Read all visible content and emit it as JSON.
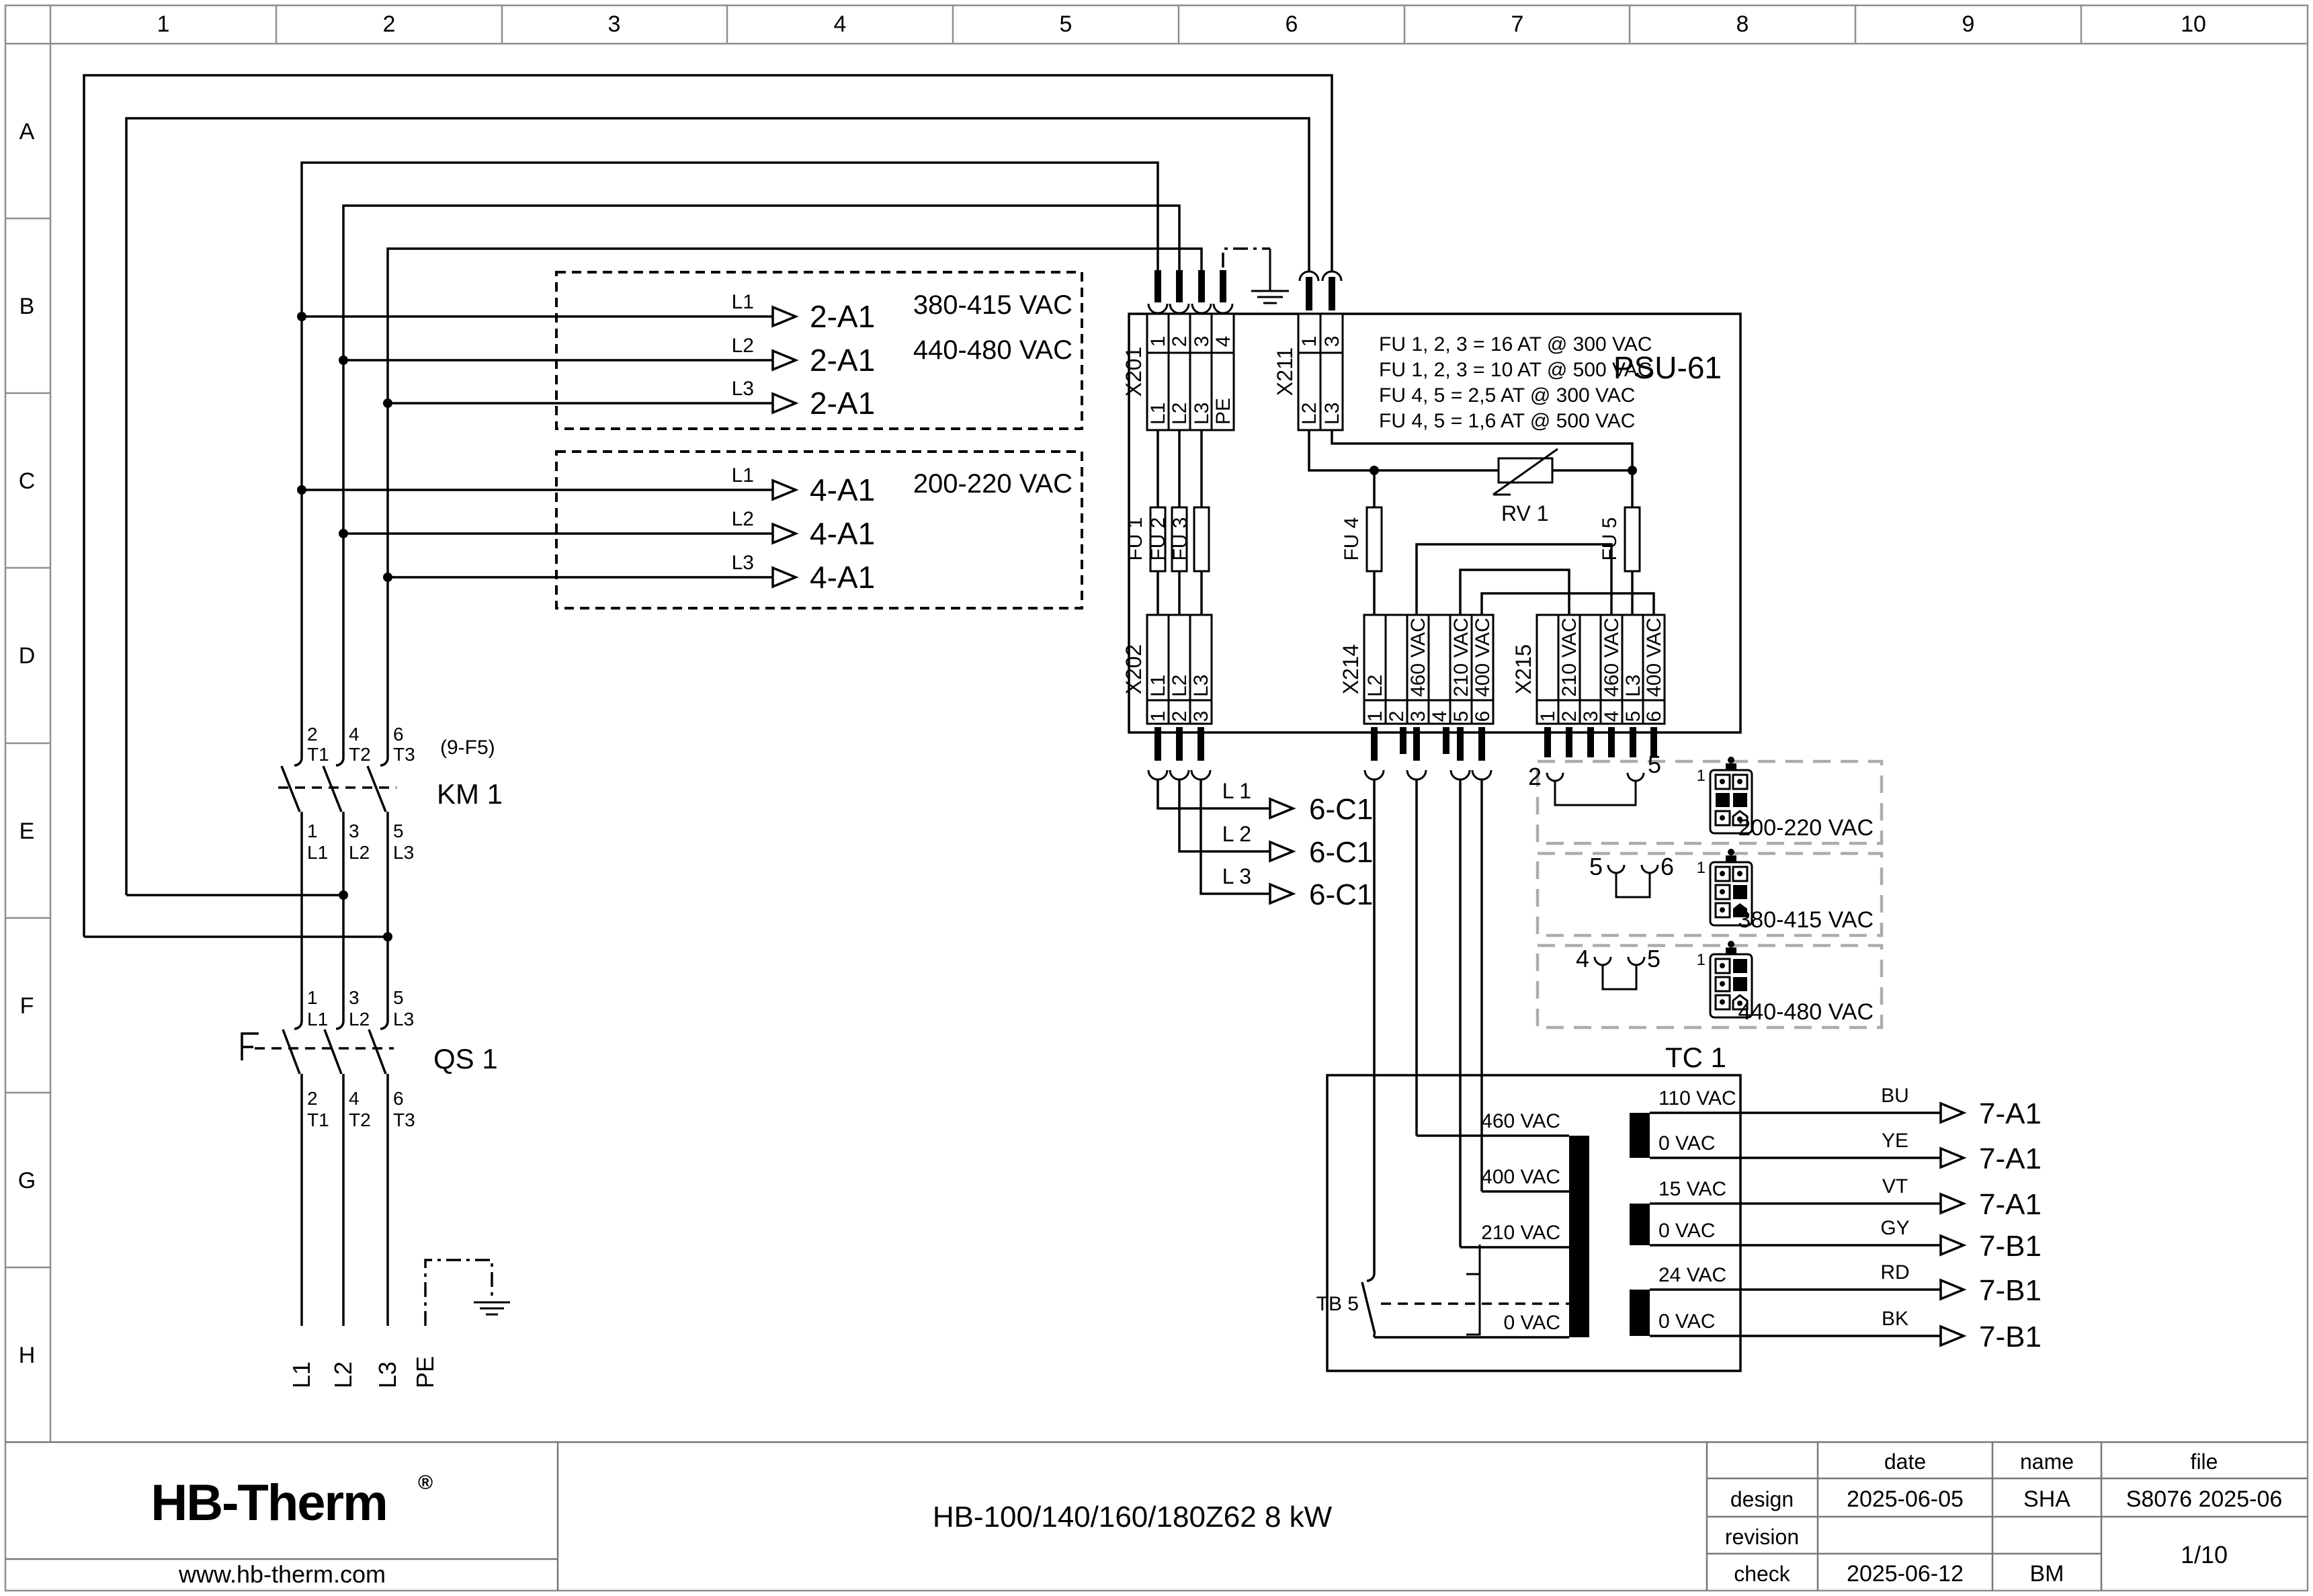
{
  "frame": {
    "columns": [
      "1",
      "2",
      "3",
      "4",
      "5",
      "6",
      "7",
      "8",
      "9",
      "10"
    ],
    "rows": [
      "A",
      "B",
      "C",
      "D",
      "E",
      "F",
      "G",
      "H"
    ]
  },
  "title_block": {
    "date_header": "date",
    "name_header": "name",
    "file_header": "file",
    "design_label": "design",
    "revision_label": "revision",
    "check_label": "check",
    "design_date": "2025-06-05",
    "design_name": "SHA",
    "file_value": "S8076 2025-06",
    "check_date": "2025-06-12",
    "check_name": "BM",
    "page": "1/10",
    "drawing_title": "HB-100/140/160/180Z62 8 kW",
    "logo": "HB-Therm",
    "logo_reg": "®",
    "website": "www.hb-therm.com",
    "brand_color": "#1c2a52"
  },
  "mains": {
    "labels": [
      "L1",
      "L2",
      "L3",
      "PE"
    ]
  },
  "km1": {
    "ref": "(9-F5)",
    "label": "KM 1",
    "top_pins": [
      "2",
      "4",
      "6"
    ],
    "top_terms": [
      "T1",
      "T2",
      "T3"
    ],
    "bottom_pins": [
      "1",
      "3",
      "5"
    ],
    "bottom_terms": [
      "L1",
      "L2",
      "L3"
    ]
  },
  "qs1": {
    "label": "QS 1",
    "top_pins": [
      "1",
      "3",
      "5"
    ],
    "top_terms": [
      "L1",
      "L2",
      "L3"
    ],
    "bottom_pins": [
      "2",
      "4",
      "6"
    ],
    "bottom_terms": [
      "T1",
      "T2",
      "T3"
    ]
  },
  "feed_2a1": {
    "voltage_1": "380-415 VAC",
    "voltage_2": "440-480 VAC",
    "rows": [
      {
        "line": "L1",
        "target": "2-A1"
      },
      {
        "line": "L2",
        "target": "2-A1"
      },
      {
        "line": "L3",
        "target": "2-A1"
      }
    ]
  },
  "feed_4a1": {
    "voltage": "200-220 VAC",
    "rows": [
      {
        "line": "L1",
        "target": "4-A1"
      },
      {
        "line": "L2",
        "target": "4-A1"
      },
      {
        "line": "L3",
        "target": "4-A1"
      }
    ]
  },
  "feed_6c1": {
    "rows": [
      {
        "line": "L 1",
        "target": "6-C1"
      },
      {
        "line": "L 2",
        "target": "6-C1"
      },
      {
        "line": "L 3",
        "target": "6-C1"
      }
    ]
  },
  "psu": {
    "title": "PSU-61",
    "fuse_notes": [
      "FU 1, 2, 3 = 16 AT @ 300 VAC",
      "FU 1, 2, 3 = 10 AT @ 500 VAC",
      "FU 4, 5 = 2,5 AT @ 300 VAC",
      "FU 4, 5 = 1,6 AT @ 500 VAC"
    ],
    "varistor": "RV 1",
    "fuses": [
      "FU 1",
      "FU 2",
      "FU 3",
      "FU 4",
      "FU 5"
    ],
    "x201": {
      "name": "X201",
      "pins": [
        "1",
        "2",
        "3",
        "4"
      ],
      "labels": [
        "L1",
        "L2",
        "L3",
        "PE"
      ]
    },
    "x211": {
      "name": "X211",
      "pins": [
        "1",
        "3"
      ],
      "labels": [
        "L2",
        "L3"
      ]
    },
    "x202": {
      "name": "X202",
      "pins": [
        "1",
        "2",
        "3"
      ],
      "labels": [
        "L1",
        "L2",
        "L3"
      ]
    },
    "x214": {
      "name": "X214",
      "pins": [
        "1",
        "2",
        "3",
        "4",
        "5",
        "6"
      ],
      "labels": [
        "L2",
        "",
        "460 VAC",
        "",
        "210 VAC",
        "400 VAC"
      ]
    },
    "x215": {
      "name": "X215",
      "pins": [
        "1",
        "2",
        "3",
        "4",
        "5",
        "6"
      ],
      "labels": [
        "",
        "210 VAC",
        "",
        "460 VAC",
        "L3",
        "400 VAC"
      ]
    }
  },
  "options": [
    {
      "pin_a": "2",
      "pin_b": "5",
      "conn_pin": "1",
      "voltage": "200-220 VAC"
    },
    {
      "pin_a": "5",
      "pin_b": "6",
      "conn_pin": "1",
      "voltage": "380-415 VAC"
    },
    {
      "pin_a": "4",
      "pin_b": "5",
      "conn_pin": "1",
      "voltage": "440-480 VAC"
    }
  ],
  "tc1": {
    "label": "TC 1",
    "thermal": "TB 5",
    "primary_taps": [
      "460 VAC",
      "400 VAC",
      "210 VAC",
      "0 VAC"
    ],
    "secondary_taps": [
      "110 VAC",
      "0 VAC",
      "15 VAC",
      "0 VAC",
      "24 VAC",
      "0 VAC"
    ],
    "outputs": [
      {
        "color": "BU",
        "target": "7-A1"
      },
      {
        "color": "YE",
        "target": "7-A1"
      },
      {
        "color": "VT",
        "target": "7-A1"
      },
      {
        "color": "GY",
        "target": "7-B1"
      },
      {
        "color": "RD",
        "target": "7-B1"
      },
      {
        "color": "BK",
        "target": "7-B1"
      }
    ]
  }
}
